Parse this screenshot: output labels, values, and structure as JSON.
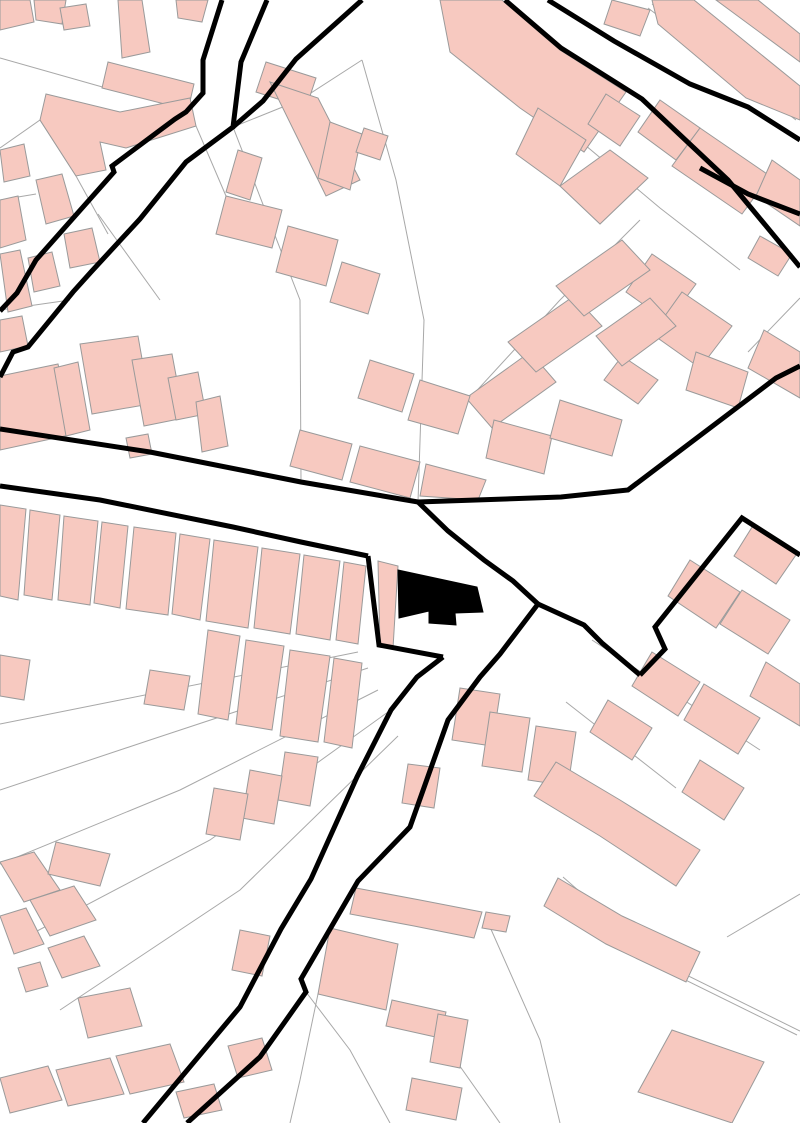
{
  "map": {
    "kind": "cadastral-figure-ground-plan",
    "canvas": {
      "width": 800,
      "height": 1123
    },
    "colors": {
      "background": "#ffffff",
      "building_fill": "#f7c9c0",
      "building_stroke": "#9a9a9a",
      "parcel_stroke": "#a8a8a8",
      "road_stroke": "#000000",
      "subject_fill": "#000000"
    },
    "roads": [
      {
        "pts": "222,0 203,60 203,93 186,112 175,119 112,166 114,172 36,260 17,293 0,311"
      },
      {
        "pts": "267,0 241,62 233,127 186,162 140,219 91,272 73,292 28,347 13,352 0,377"
      },
      {
        "pts": "362,0 296,59 263,101 233,127"
      },
      {
        "pts": "548,0 614,41 690,84 748,107 800,140"
      },
      {
        "pts": "505,0 561,48 642,99 678,133 728,180 800,267"
      },
      {
        "pts": "700,168 748,194 800,214"
      },
      {
        "pts": "0,429 150,452 301,482 418,502 561,497 628,490 776,378 800,366"
      },
      {
        "pts": "0,486 100,500 233,527 301,542 368,556"
      },
      {
        "pts": "368,556 379,645 443,657"
      },
      {
        "pts": "418,502 448,531 484,560 513,581 538,604"
      },
      {
        "pts": "538,604 500,654 480,677 448,720 410,827 358,881 301,979 306,992 260,1057 187,1123"
      },
      {
        "pts": "443,657 417,677 391,710 357,777 311,879 281,929 240,1007 143,1123"
      },
      {
        "pts": "800,555 742,518 655,627 665,649 640,675"
      },
      {
        "pts": "538,604 584,625 602,643 640,675"
      }
    ],
    "parcels": [
      {
        "pts": "0,58 120,92"
      },
      {
        "pts": "0,148 40,120 76,176"
      },
      {
        "pts": "233,127 300,100 362,60"
      },
      {
        "pts": "233,127 300,300 301,482"
      },
      {
        "pts": "362,60 396,180 424,320 418,502"
      },
      {
        "pts": "652,4 800,116"
      },
      {
        "pts": "648,8 796,120"
      },
      {
        "pts": "560,124 660,208 740,270"
      },
      {
        "pts": "470,398 560,300 640,220"
      },
      {
        "pts": "358,652 120,700 0,724"
      },
      {
        "pts": "368,668 150,740 0,790"
      },
      {
        "pts": "378,690 180,790 0,864"
      },
      {
        "pts": "388,712 210,840 20,940"
      },
      {
        "pts": "398,736 240,890 60,1010"
      },
      {
        "pts": "563,877 660,962 800,1031"
      },
      {
        "pts": "560,881 657,966 797,1035"
      },
      {
        "pts": "486,918 540,1040 560,1123"
      },
      {
        "pts": "727,937 800,894"
      },
      {
        "pts": "440,1038 500,1123"
      },
      {
        "pts": "318,994 300,1080 290,1123"
      },
      {
        "pts": "800,298 748,352"
      },
      {
        "pts": "592,640 760,750"
      },
      {
        "pts": "566,702 676,788"
      },
      {
        "pts": "306,992 350,1050 390,1123"
      },
      {
        "pts": "0,310 70,300"
      },
      {
        "pts": "98,214 160,300"
      },
      {
        "pts": "196,126 226,196"
      },
      {
        "pts": "418,502 300,482"
      },
      {
        "pts": "76,176 108,234"
      },
      {
        "pts": "0,200 36,194"
      }
    ],
    "buildings": [
      {
        "pts": "0,0 30,0 34,22 0,30"
      },
      {
        "pts": "34,0 66,0 62,24 36,20"
      },
      {
        "pts": "118,0 142,0 150,52 122,58"
      },
      {
        "pts": "60,8 86,4 90,26 64,30"
      },
      {
        "pts": "176,0 208,0 202,22 178,18"
      },
      {
        "pts": "108,62 194,84 188,110 102,88"
      },
      {
        "pts": "46,94 120,112 190,98 196,126 126,148 100,142 106,170 76,176 40,120"
      },
      {
        "pts": "0,150 24,144 30,176 4,182"
      },
      {
        "pts": "36,180 62,174 74,216 46,224"
      },
      {
        "pts": "0,200 18,196 26,240 0,248"
      },
      {
        "pts": "0,254 20,250 32,306 8,312"
      },
      {
        "pts": "28,258 52,252 60,286 34,292"
      },
      {
        "pts": "64,234 92,228 100,262 70,268"
      },
      {
        "pts": "0,320 22,316 28,346 0,352"
      },
      {
        "pts": "266,62 316,78 306,108 256,92"
      },
      {
        "pts": "270,82 318,98 360,180 326,196"
      },
      {
        "pts": "330,122 362,134 350,190 318,178"
      },
      {
        "pts": "364,128 388,136 380,160 356,152"
      },
      {
        "pts": "440,0 502,0 560,50 626,92 584,152 520,108 450,52"
      },
      {
        "pts": "538,108 586,140 560,186 516,154"
      },
      {
        "pts": "560,186 610,150 648,178 600,224"
      },
      {
        "pts": "606,94 640,116 620,146 588,124"
      },
      {
        "pts": "612,0 650,10 640,36 604,24"
      },
      {
        "pts": "652,0 694,0 800,86 800,120 746,98 658,24"
      },
      {
        "pts": "716,0 758,0 800,34 800,62"
      },
      {
        "pts": "660,100 700,128 676,160 638,132"
      },
      {
        "pts": "700,128 770,176 742,214 672,166"
      },
      {
        "pts": "772,160 800,180 800,226 756,196"
      },
      {
        "pts": "760,236 792,254 778,276 748,258"
      },
      {
        "pts": "652,254 696,284 668,322 626,292"
      },
      {
        "pts": "682,292 732,326 700,368 652,334"
      },
      {
        "pts": "764,330 800,352 800,398 748,368"
      },
      {
        "pts": "622,356 658,380 638,404 604,380"
      },
      {
        "pts": "696,352 748,372 738,408 686,390"
      },
      {
        "pts": "238,150 262,158 250,200 226,192"
      },
      {
        "pts": "226,196 282,210 272,248 216,234"
      },
      {
        "pts": "288,226 338,240 326,286 276,272"
      },
      {
        "pts": "342,262 380,274 368,314 330,302"
      },
      {
        "pts": "466,398 530,352 556,382 492,428"
      },
      {
        "pts": "508,342 574,296 602,326 536,372"
      },
      {
        "pts": "556,286 622,240 650,270 584,316"
      },
      {
        "pts": "596,336 650,298 676,326 622,366"
      },
      {
        "pts": "370,360 414,374 402,412 358,398"
      },
      {
        "pts": "420,380 470,396 458,434 408,420"
      },
      {
        "pts": "300,430 352,444 342,480 290,466"
      },
      {
        "pts": "360,446 420,462 410,498 350,482"
      },
      {
        "pts": "426,464 486,480 478,500 420,496"
      },
      {
        "pts": "494,420 552,436 544,474 486,458"
      },
      {
        "pts": "560,400 622,420 612,456 550,438"
      },
      {
        "pts": "0,376 58,364 74,434 0,450"
      },
      {
        "pts": "54,368 78,362 90,430 66,436"
      },
      {
        "pts": "80,344 138,336 150,404 92,414"
      },
      {
        "pts": "132,360 172,354 184,418 144,426"
      },
      {
        "pts": "168,378 198,372 206,414 176,420"
      },
      {
        "pts": "196,402 220,396 228,446 202,452"
      },
      {
        "pts": "126,438 148,434 152,454 130,458"
      },
      {
        "pts": "0,505 26,509 18,600 0,596"
      },
      {
        "pts": "30,510 60,515 52,600 24,595"
      },
      {
        "pts": "64,516 98,521 90,605 58,600"
      },
      {
        "pts": "102,522 128,526 120,608 94,603"
      },
      {
        "pts": "134,527 176,533 168,615 126,609"
      },
      {
        "pts": "180,534 210,539 200,620 172,614"
      },
      {
        "pts": "214,540 258,547 248,628 206,621"
      },
      {
        "pts": "262,548 300,554 290,634 254,628"
      },
      {
        "pts": "304,555 340,561 330,640 296,634"
      },
      {
        "pts": "344,562 366,566 358,644 336,640"
      },
      {
        "pts": "208,630 240,636 228,720 198,714"
      },
      {
        "pts": "246,640 284,646 272,730 236,724"
      },
      {
        "pts": "290,650 330,656 318,742 280,736"
      },
      {
        "pts": "334,658 362,663 352,748 324,742"
      },
      {
        "pts": "150,670 190,676 184,710 144,704"
      },
      {
        "pts": "0,655 30,660 24,700 0,696"
      },
      {
        "pts": "378,561 398,566 393,648 380,646"
      },
      {
        "pts": "285,752 318,757 310,806 278,800"
      },
      {
        "pts": "250,770 282,776 274,824 242,818"
      },
      {
        "pts": "214,788 248,794 240,840 206,834"
      },
      {
        "pts": "408,764 440,768 434,808 402,803"
      },
      {
        "pts": "460,688 500,694 492,746 452,740"
      },
      {
        "pts": "490,712 530,718 522,772 482,766"
      },
      {
        "pts": "536,726 576,732 568,786 528,780"
      },
      {
        "pts": "754,524 798,552 776,584 734,556"
      },
      {
        "pts": "690,560 740,592 716,628 668,596"
      },
      {
        "pts": "742,590 790,620 768,654 720,624"
      },
      {
        "pts": "652,652 700,682 678,716 632,686"
      },
      {
        "pts": "704,684 760,718 738,754 684,720"
      },
      {
        "pts": "766,662 800,684 800,726 750,696"
      },
      {
        "pts": "608,700 652,728 632,760 590,732"
      },
      {
        "pts": "700,760 744,788 724,820 682,792"
      },
      {
        "pts": "556,762 620,800 700,850 676,886 600,836 534,796"
      },
      {
        "pts": "356,888 420,900 482,912 474,938 414,926 350,914"
      },
      {
        "pts": "486,912 510,916 506,932 482,928"
      },
      {
        "pts": "330,928 398,944 386,1010 318,994"
      },
      {
        "pts": "392,1000 446,1012 440,1038 386,1026"
      },
      {
        "pts": "438,1014 468,1020 460,1068 430,1062"
      },
      {
        "pts": "412,1078 462,1088 456,1120 406,1110"
      },
      {
        "pts": "0,862 34,852 60,890 24,902"
      },
      {
        "pts": "30,900 74,886 96,920 50,936"
      },
      {
        "pts": "0,916 26,908 44,944 14,954"
      },
      {
        "pts": "48,948 84,936 100,966 62,978"
      },
      {
        "pts": "56,842 110,854 100,886 48,874"
      },
      {
        "pts": "18,968 40,962 48,986 26,992"
      },
      {
        "pts": "78,998 130,988 142,1026 88,1038"
      },
      {
        "pts": "0,1078 48,1066 62,1100 10,1113"
      },
      {
        "pts": "56,1070 110,1058 124,1094 68,1106"
      },
      {
        "pts": "116,1056 170,1044 184,1082 130,1094"
      },
      {
        "pts": "176,1092 214,1084 222,1110 184,1118"
      },
      {
        "pts": "228,1046 262,1038 272,1070 238,1078"
      },
      {
        "pts": "240,930 270,936 262,976 232,970"
      },
      {
        "pts": "672,1030 764,1062 732,1123 638,1092"
      },
      {
        "pts": "558,878 622,916 700,952 686,982 606,944 544,906"
      }
    ],
    "subject_building": {
      "label": "highlighted-subject-building",
      "pts": "398,570 477,587 483,612 455,613 456,625 429,623 429,611 399,618"
    }
  }
}
